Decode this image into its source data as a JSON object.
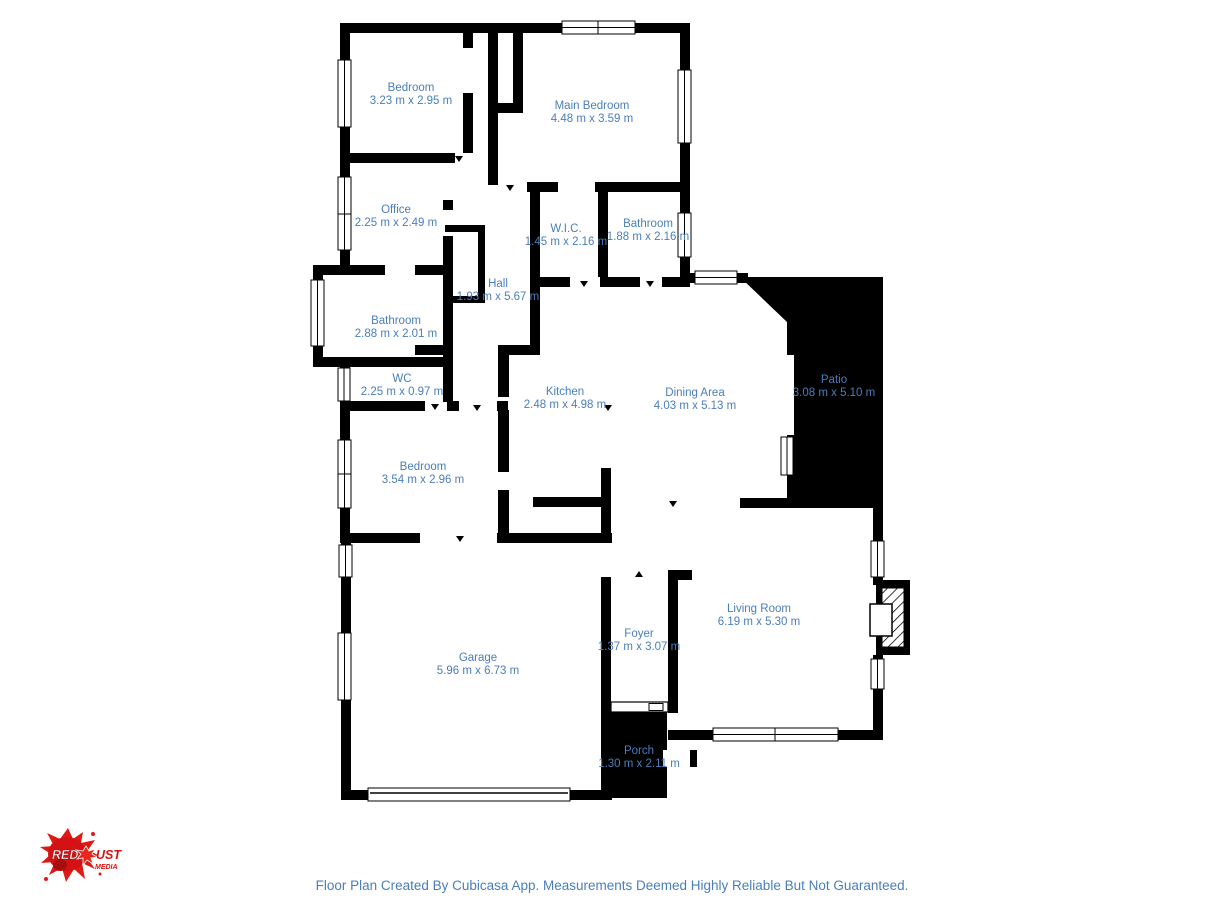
{
  "floor_plan": {
    "rooms": [
      {
        "name": "Bedroom",
        "dims": "3.23 m x 2.95 m"
      },
      {
        "name": "Main Bedroom",
        "dims": "4.48 m x 3.59 m"
      },
      {
        "name": "Office",
        "dims": "2.25 m x 2.49 m"
      },
      {
        "name": "W.I.C.",
        "dims": "1.45 m x 2.16 m"
      },
      {
        "name": "Bathroom",
        "dims": "1.88 m x 2.16 m"
      },
      {
        "name": "Hall",
        "dims": "1.93 m x 5.67 m"
      },
      {
        "name": "Bathroom",
        "dims": "2.88 m x 2.01 m"
      },
      {
        "name": "WC",
        "dims": "2.25 m x 0.97 m"
      },
      {
        "name": "Kitchen",
        "dims": "2.48 m x 4.98 m"
      },
      {
        "name": "Dining Area",
        "dims": "4.03 m x 5.13 m"
      },
      {
        "name": "Patio",
        "dims": "3.08 m x 5.10 m"
      },
      {
        "name": "Bedroom",
        "dims": "3.54 m x 2.96 m"
      },
      {
        "name": "Garage",
        "dims": "5.96 m x 6.73 m"
      },
      {
        "name": "Foyer",
        "dims": "1.37 m x 3.07 m"
      },
      {
        "name": "Living Room",
        "dims": "6.19 m x 5.30 m"
      },
      {
        "name": "Porch",
        "dims": "1.30 m x 2.11 m"
      }
    ],
    "features": [
      "fireplace",
      "patio",
      "porch",
      "garage-door",
      "entry-door",
      "windows"
    ]
  },
  "logo": {
    "red": "RED",
    "dust": "UST",
    "media": "MEDIA"
  },
  "footer": {
    "disclaimer": "Floor Plan Created By Cubicasa App. Measurements Deemed Highly Reliable But Not Guaranteed."
  },
  "colors": {
    "label_blue": "#4a7ebb",
    "wall_black": "#000000",
    "background": "#ffffff",
    "logo_red": "#d6120f"
  }
}
